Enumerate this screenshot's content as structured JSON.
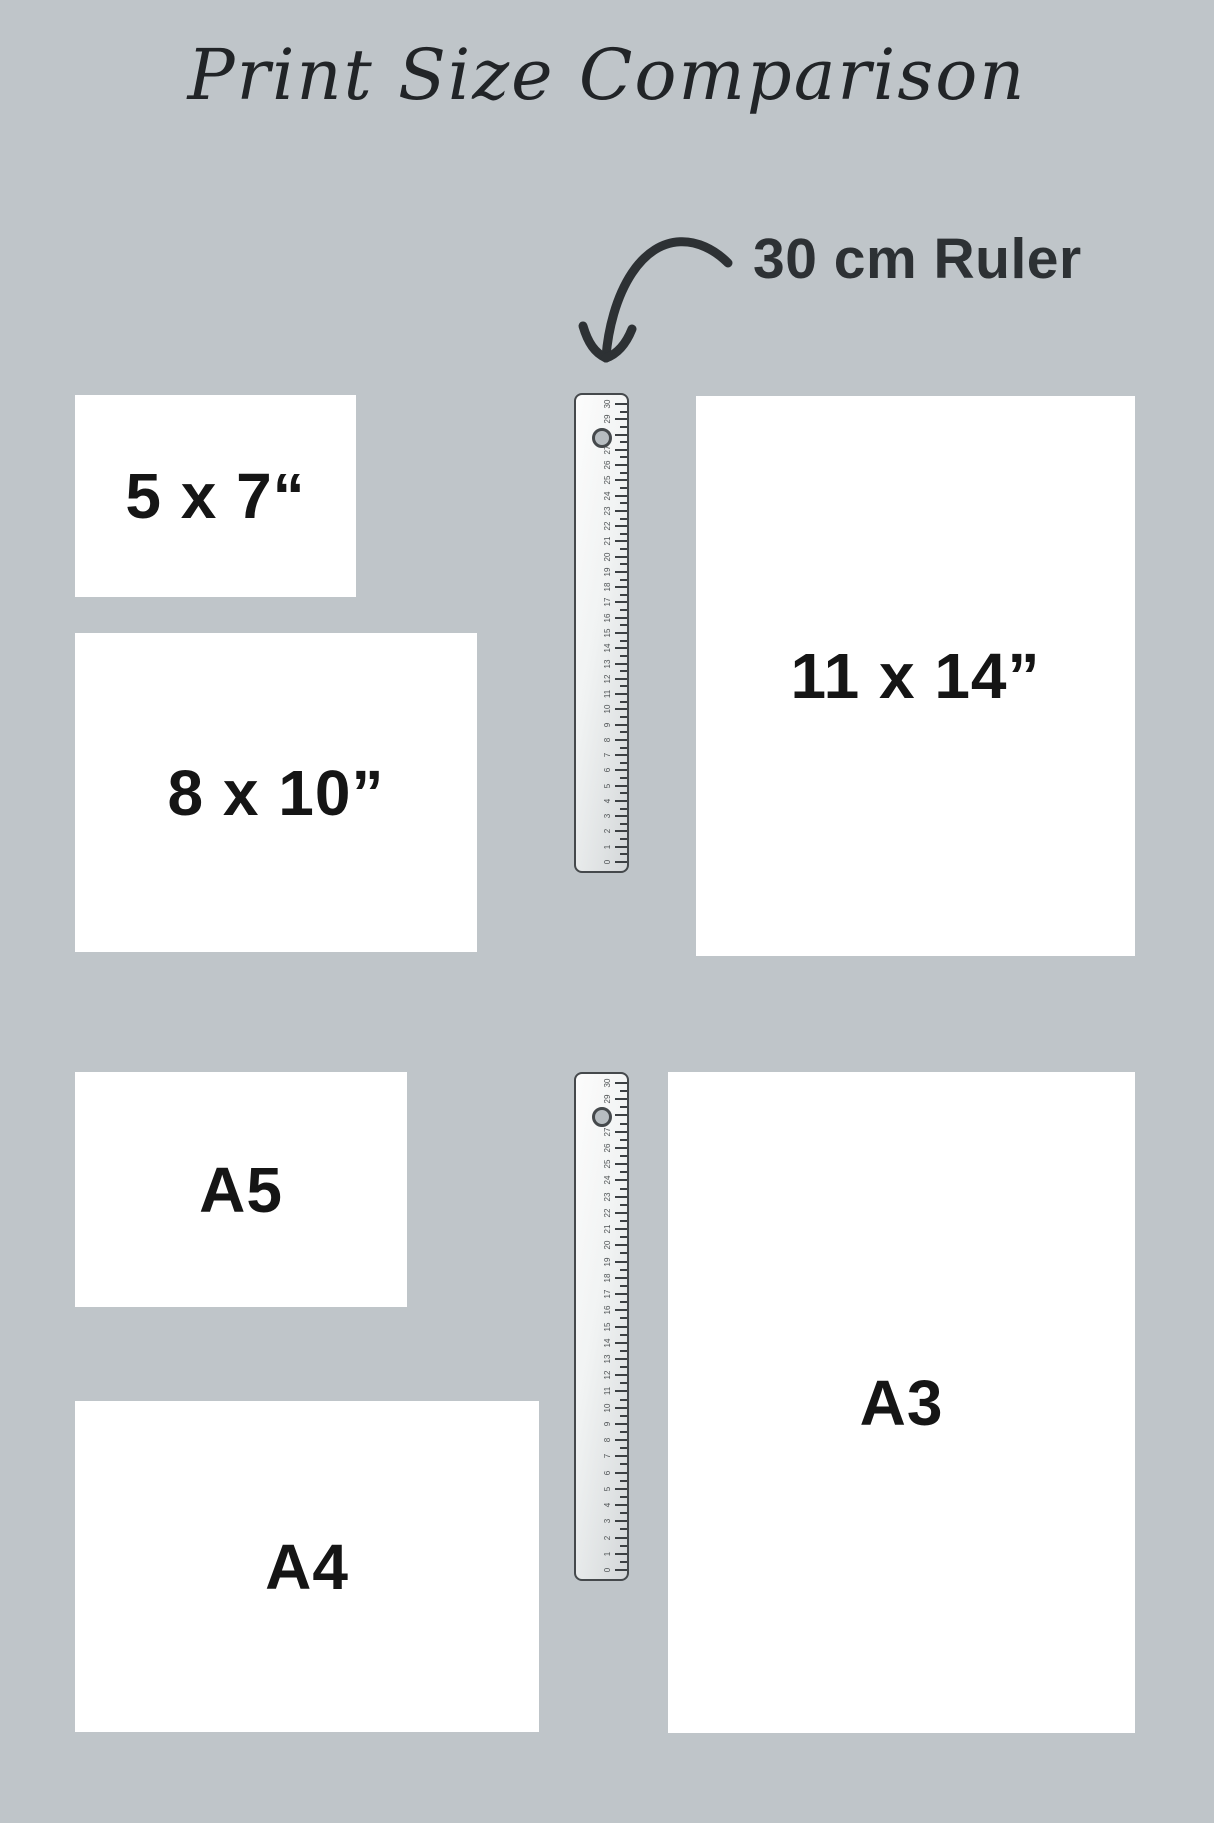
{
  "title": "Print Size Comparison",
  "annotation": {
    "ruler_label": "30 cm Ruler"
  },
  "print_sizes": [
    {
      "name": "5x7",
      "label": "5 x 7“"
    },
    {
      "name": "8x10",
      "label": "8 x 10”"
    },
    {
      "name": "11x14",
      "label": "11 x 14”"
    },
    {
      "name": "A5",
      "label": "A5"
    },
    {
      "name": "A4",
      "label": "A4"
    },
    {
      "name": "A3",
      "label": "A3"
    }
  ],
  "ruler": {
    "unit": "cm",
    "min": 0,
    "max": 30,
    "tick_labels": [
      "30",
      "29",
      "28",
      "27",
      "26",
      "25",
      "24",
      "23",
      "22",
      "21",
      "20",
      "19",
      "18",
      "17",
      "16",
      "15",
      "14",
      "13",
      "12",
      "11",
      "10",
      "9",
      "8",
      "7",
      "6",
      "5",
      "4",
      "3",
      "2",
      "1",
      "0"
    ]
  },
  "colors": {
    "background": "#bfc5c9",
    "box_fill": "#ffffff",
    "label_text": "#151515",
    "title_text": "#212427",
    "arrow_and_callout": "#2d3134",
    "ruler_border": "#45494c"
  }
}
